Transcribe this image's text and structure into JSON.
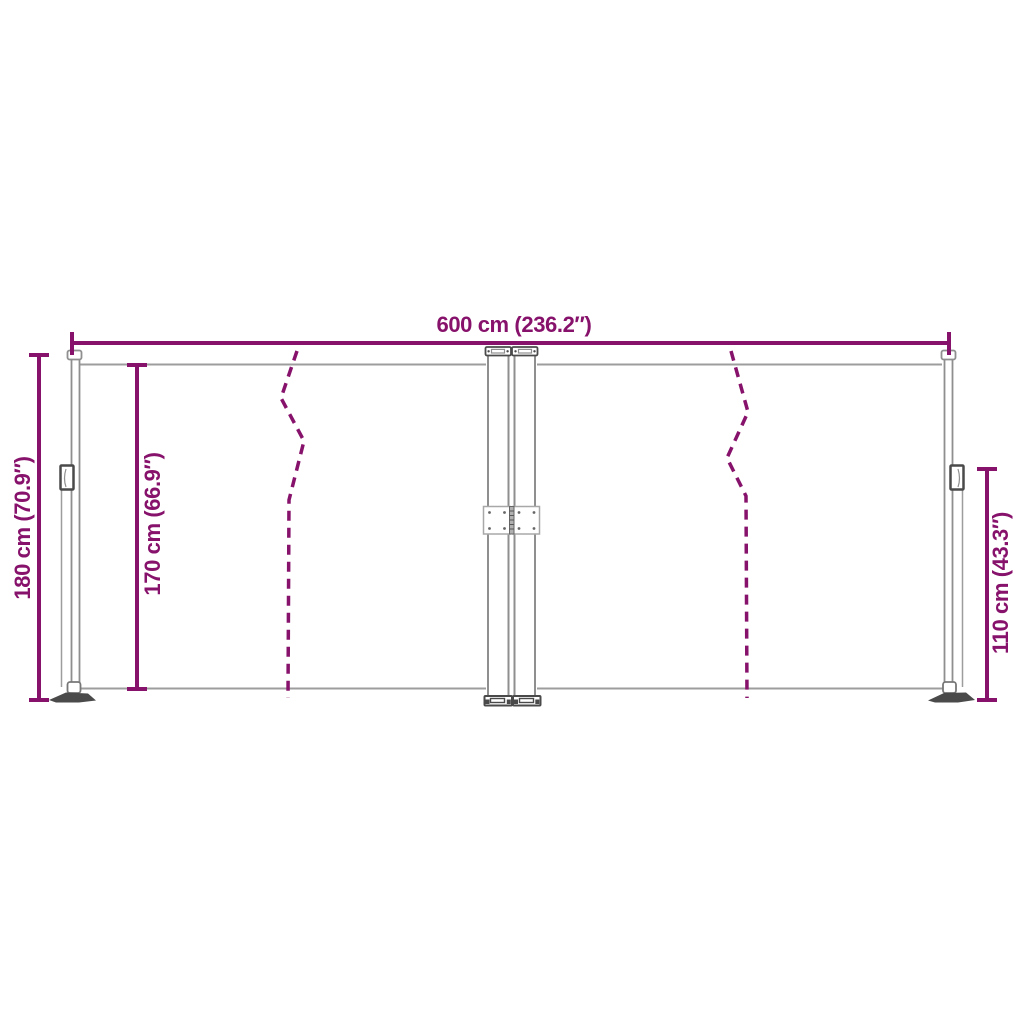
{
  "colors": {
    "dimension_accent": "#87126b",
    "frame_line": "#8f8f8f",
    "fabric_line": "#9d9d9d",
    "dark_metal": "#4a4a4a",
    "background": "#ffffff"
  },
  "diagram": {
    "dimensions": {
      "total_width": {
        "label": "600 cm (236.2″)",
        "cm": 600,
        "in": 236.2
      },
      "total_height": {
        "label": "180 cm (70.9″)",
        "cm": 180,
        "in": 70.9
      },
      "fabric_height": {
        "label": "170 cm (66.9″)",
        "cm": 170,
        "in": 66.9
      },
      "right_post_height": {
        "label": "110 cm (43.3″)",
        "cm": 110,
        "in": 43.3
      }
    }
  }
}
